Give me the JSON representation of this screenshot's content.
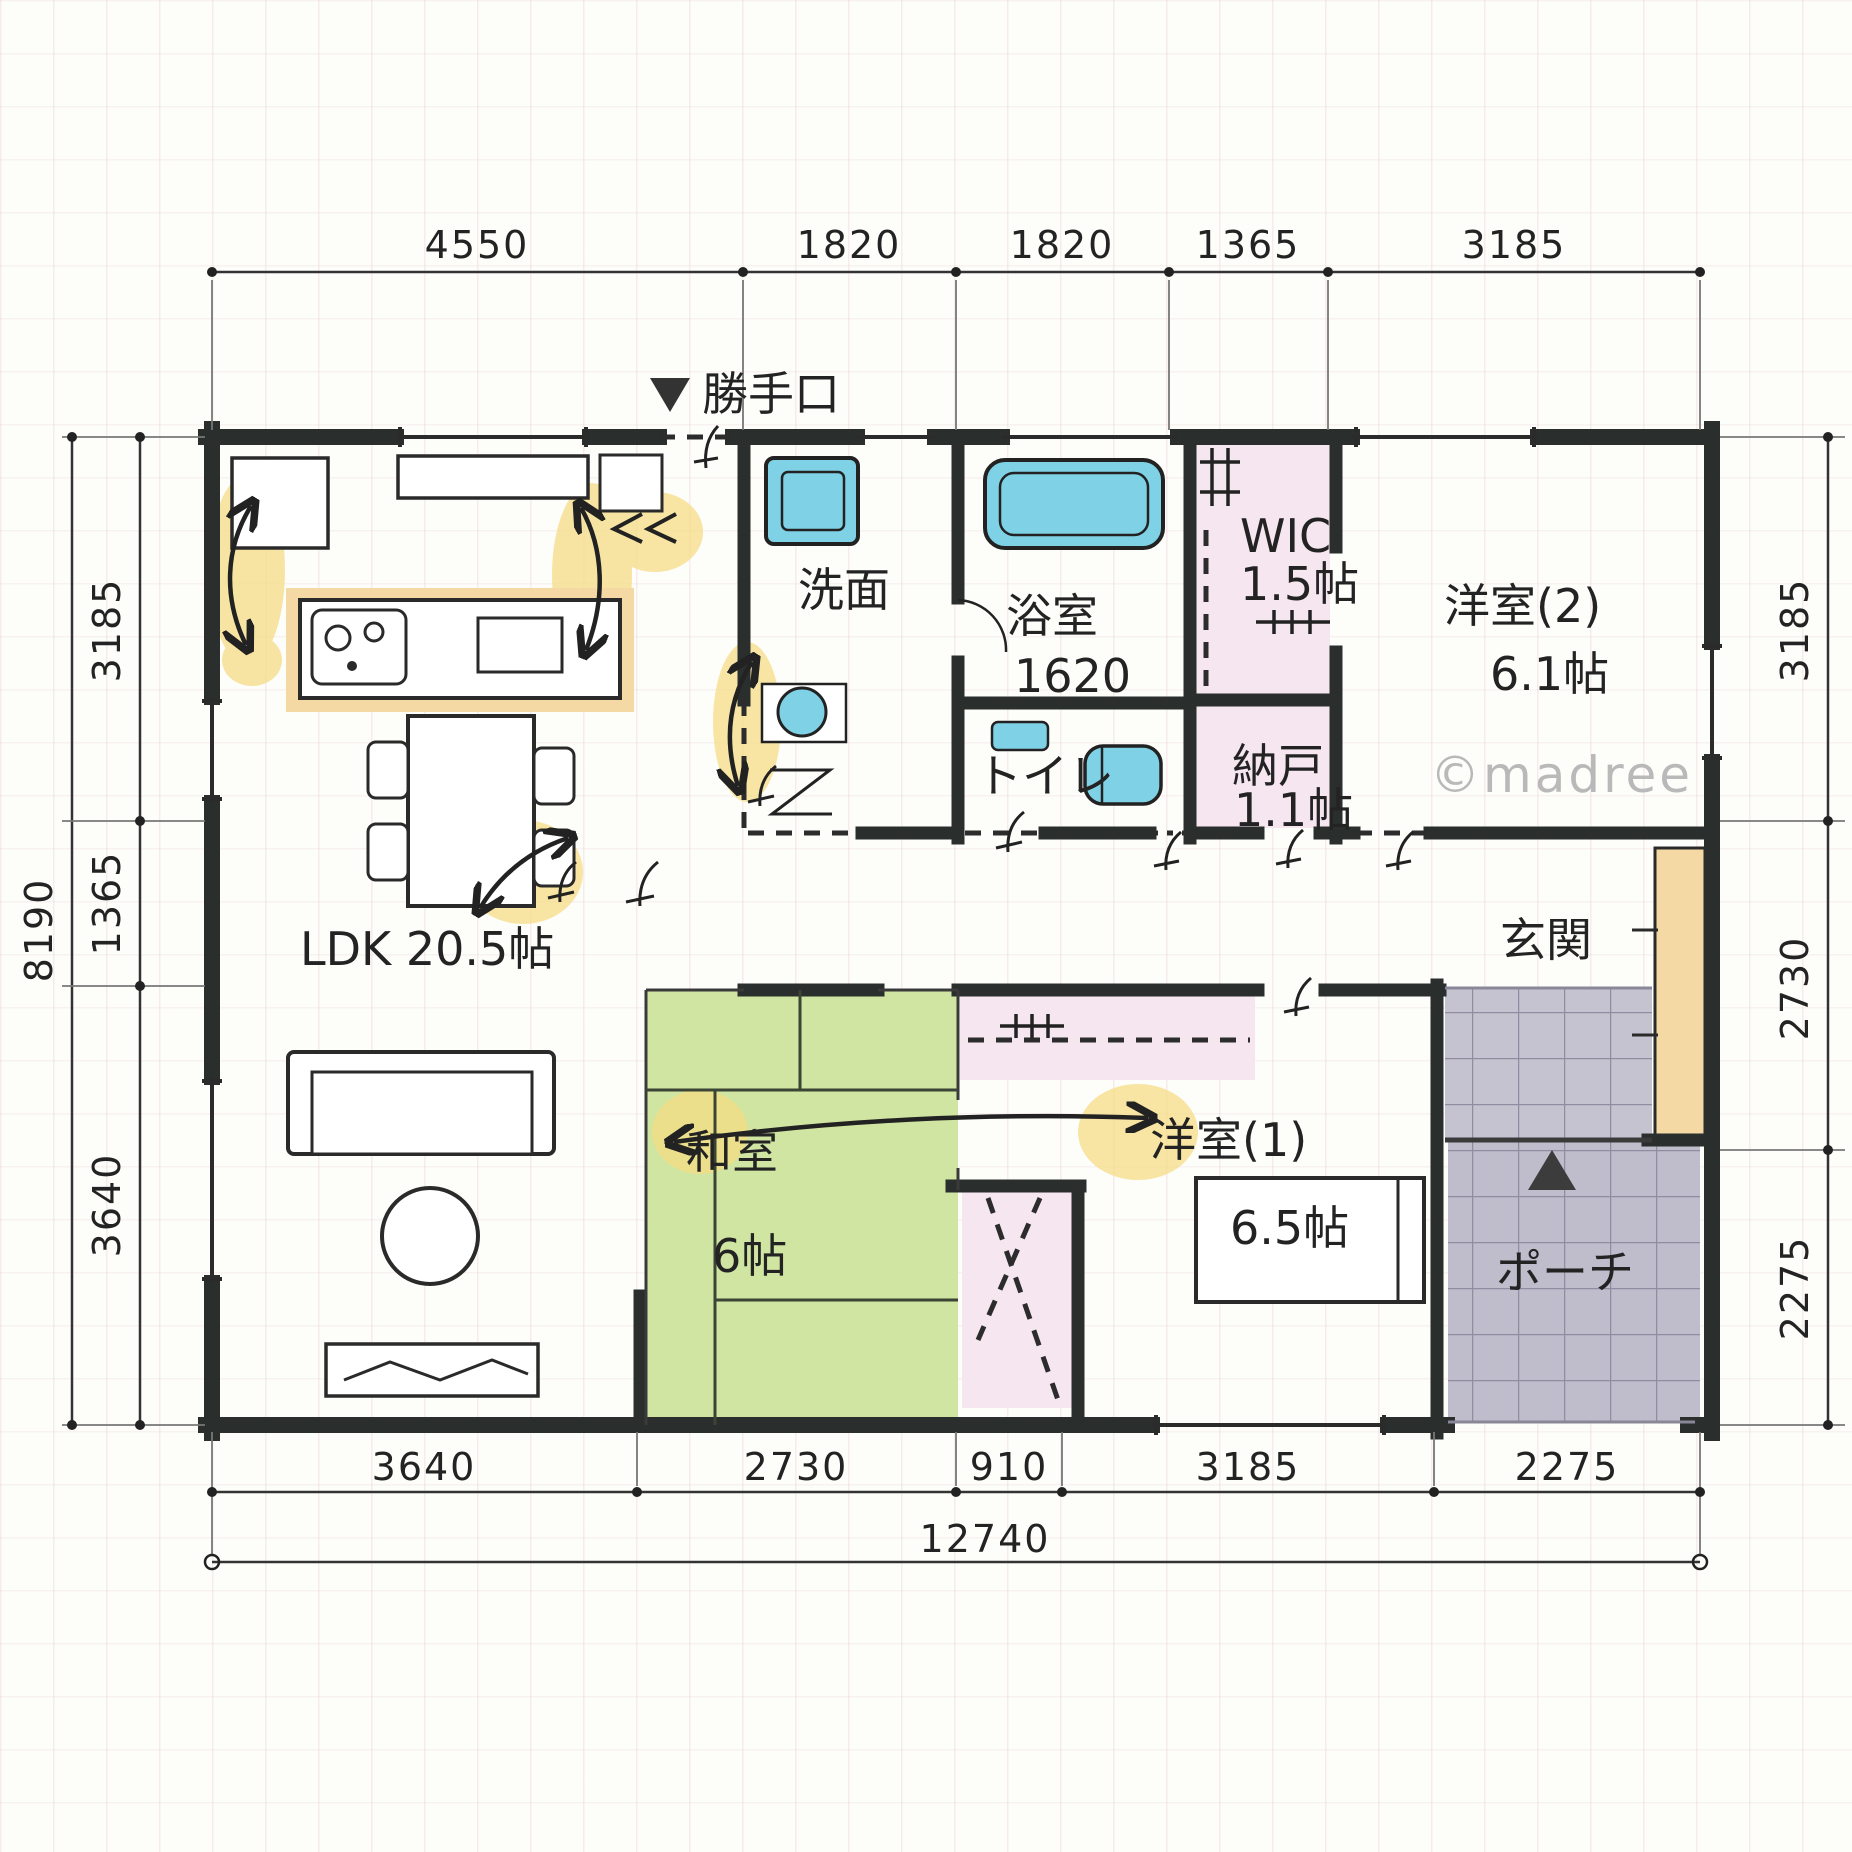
{
  "watermark": "©madree",
  "dimensions": {
    "top": [
      "4550",
      "1820",
      "1820",
      "1365",
      "3185"
    ],
    "bottom": [
      "3640",
      "2730",
      "910",
      "3185",
      "2275"
    ],
    "bottom_total": "12740",
    "left_outer": "8190",
    "left_inner": [
      "3185",
      "1365",
      "3640"
    ],
    "right": [
      "3185",
      "2730",
      "2275"
    ]
  },
  "rooms": {
    "ldk": {
      "label": "LDK 20.5帖"
    },
    "backdoor": {
      "label": "勝手口"
    },
    "washroom": {
      "label": "洗面"
    },
    "bath": {
      "label": "浴室",
      "size": "1620"
    },
    "toilet": {
      "label": "トイレ"
    },
    "wic": {
      "label": "WIC",
      "size": "1.5帖"
    },
    "storage": {
      "label": "納戸",
      "size": "1.1帖"
    },
    "bedroom2": {
      "label": "洋室(2)",
      "size": "6.1帖"
    },
    "bedroom1": {
      "label": "洋室(1)",
      "size": "6.5帖"
    },
    "tatami": {
      "label": "和室",
      "size": "6帖"
    },
    "entrance": {
      "label": "玄関"
    },
    "porch": {
      "label": "ポーチ"
    }
  },
  "colors": {
    "wall": "#2a2e2d",
    "tatami_green": "#cfe5a1",
    "closet_pink": "#f6e6ef",
    "fixture_blue": "#7fd2e6",
    "counter_tan": "#f5d9a4",
    "tile_gray": "#c6c3d1",
    "highlight_yellow": "#f6dc85",
    "watermark_gray": "#b9b9b9"
  }
}
